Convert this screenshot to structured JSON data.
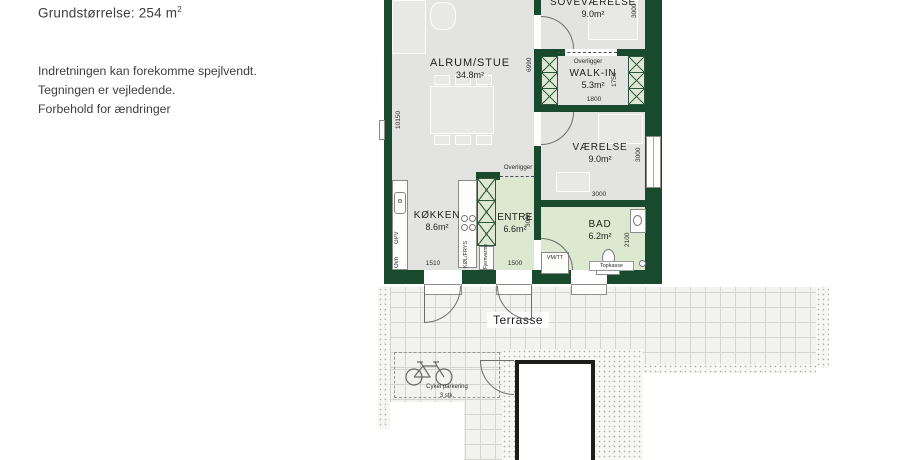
{
  "notes": {
    "size_prefix": "Grundstørrelse: 254 m",
    "size_sup": "2",
    "lines": [
      "Indretningen kan forekomme spejlvendt.",
      "Tegningen er vejledende.",
      "Forbehold for ændringer"
    ]
  },
  "plan": {
    "rooms": [
      {
        "name": "ALRUM/STUE",
        "area": "34.8m²"
      },
      {
        "name": "SOVEVÆRELSE",
        "area": "9.0m²"
      },
      {
        "name": "WALK-IN",
        "area": "5.3m²"
      },
      {
        "name": "VÆRELSE",
        "area": "9.0m²"
      },
      {
        "name": "KØKKEN",
        "area": "8.6m²"
      },
      {
        "name": "ENTRE",
        "area": "6.6m²"
      },
      {
        "name": "BAD",
        "area": "6.2m²"
      }
    ],
    "labels": {
      "terrasse": "Terrasse",
      "cykel": "Cykel parkering",
      "cykel_count": "3 stk.",
      "overligger": "Overligger",
      "fjernvarme": "Fjernvarme",
      "gpv": "GPV",
      "ovn": "Ovn",
      "kol_frys": "KØL/FRYS",
      "vm_tt": "VM/TT",
      "topkasse": "Topkasse"
    },
    "dims": {
      "left_height": "10150",
      "stue_height": "6990",
      "w3000": "3000",
      "walkin_h": "1750",
      "walkin_w": "1800",
      "kokken_w": "1510",
      "entre_w": "1500",
      "entre_h": "3080",
      "bad_h": "2100"
    },
    "colors": {
      "wall": "#1a4a2e",
      "floor_gray": "#e3e3e1",
      "floor_green": "#dde8d0",
      "tile_line": "#d5d5d0"
    }
  }
}
